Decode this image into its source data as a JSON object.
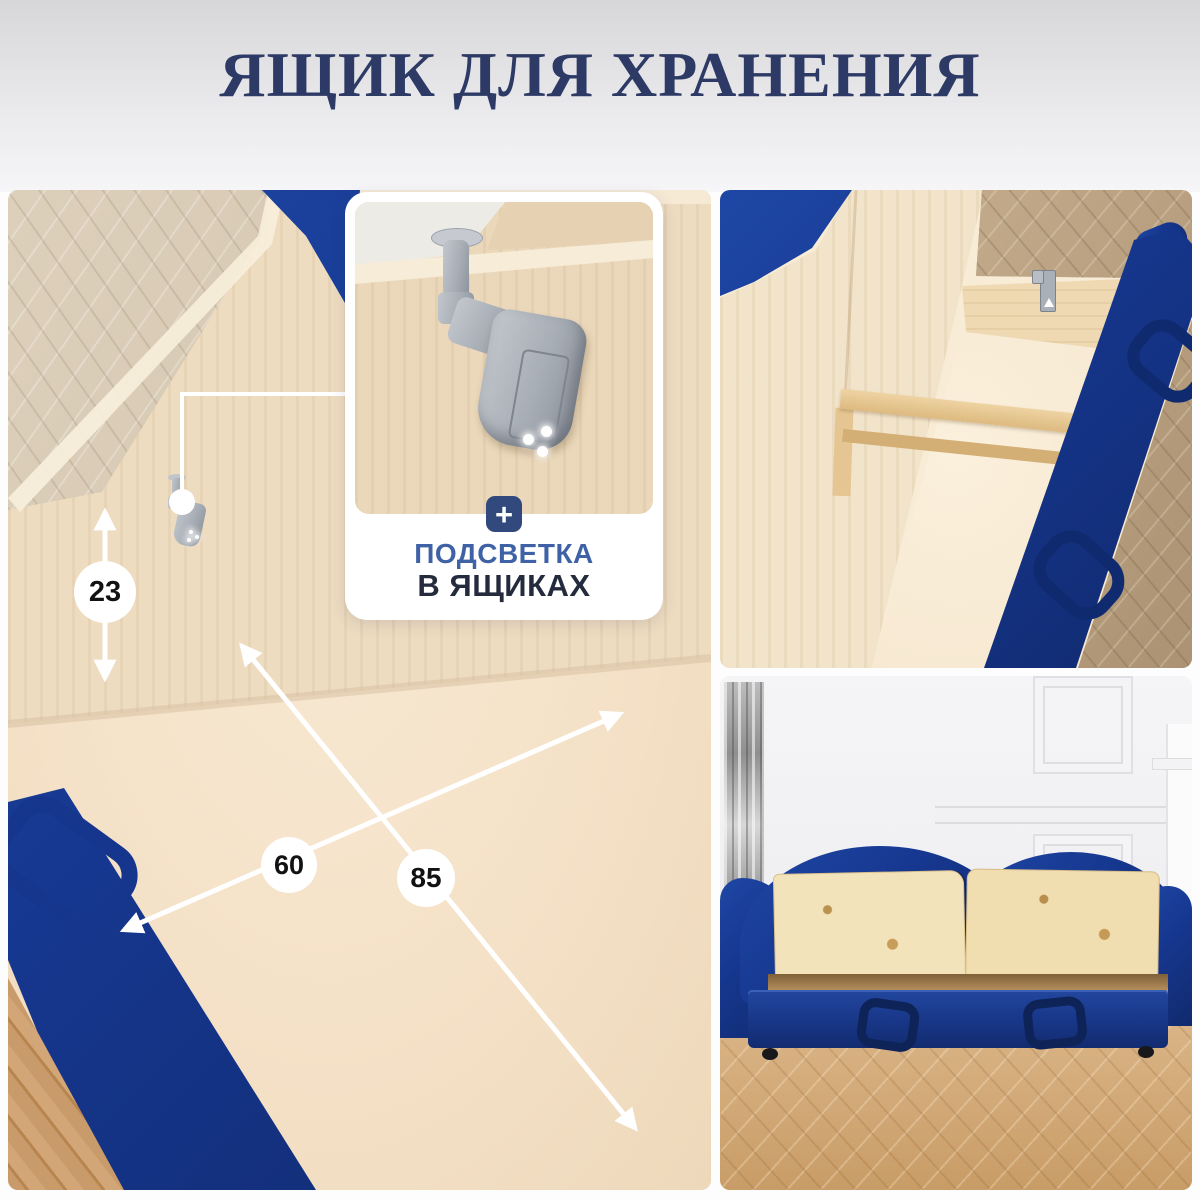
{
  "title": "ЯЩИК ДЛЯ ХРАНЕНИЯ",
  "callout": {
    "plus_icon": "+",
    "line1": "ПОДСВЕТКА",
    "line2": "В ЯЩИКАХ"
  },
  "measurements": {
    "side_height_cm": "23",
    "width_cm": "60",
    "depth_cm": "85"
  },
  "colors": {
    "title_navy": "#2d3a66",
    "accent_blue": "#32497e",
    "label_blue": "#3f62a6",
    "label_dark": "#232b3c",
    "fabric_navy": "#16378f",
    "annotation_white": "#ffffff"
  }
}
